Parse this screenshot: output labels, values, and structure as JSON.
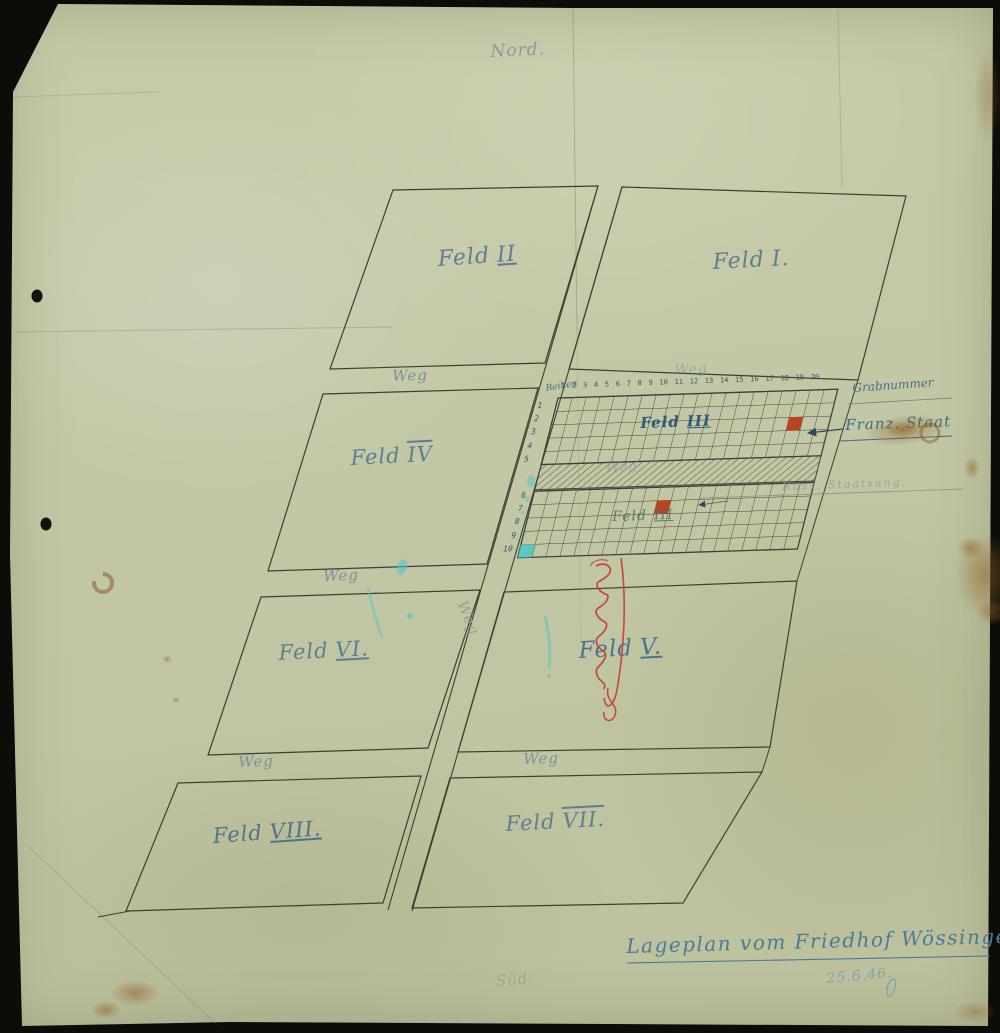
{
  "scan": {
    "compass_north": "Nord.",
    "compass_south": "Süd.",
    "title": "Lageplan vom Friedhof Wössingen.",
    "date": "25.6.46.",
    "fields": [
      {
        "label": "Feld",
        "numeral": "II"
      },
      {
        "label": "Feld",
        "numeral": "I."
      },
      {
        "label": "Feld",
        "numeral": "IV"
      },
      {
        "label": "Feld",
        "numeral": "III"
      },
      {
        "label": "Feld",
        "numeral": "III"
      },
      {
        "label": "Feld",
        "numeral": "VI."
      },
      {
        "label": "Feld",
        "numeral": "V."
      },
      {
        "label": "Feld",
        "numeral": "VIII."
      },
      {
        "label": "Feld",
        "numeral": "VII."
      }
    ],
    "weg_labels": [
      "Weg",
      "Weg",
      "Weg",
      "Weg",
      "Weg",
      "Weg",
      "Weg"
    ],
    "grid": {
      "rows_label": "Reihen",
      "grabnummer_label": "Grabnummer",
      "row_numbers_upper": "1\n2\n3\n4\n5",
      "row_numbers_lower": "6\n7\n8\n9\n10",
      "column_numbers": "1 2 3 4 5 6 7 8 9 10 11 12 13 14 15 16 17 18 19 20"
    },
    "annotations": {
      "grave_marker_1": "Franz. Staat",
      "grave_marker_2": "Russ. Staatsang."
    },
    "colors": {
      "red_marker": "#b9441f",
      "teal_marker": "#4ec7c6",
      "blue_ink": "#46718c",
      "ink": "#3b4034",
      "paper": "#c3c8a6"
    }
  }
}
